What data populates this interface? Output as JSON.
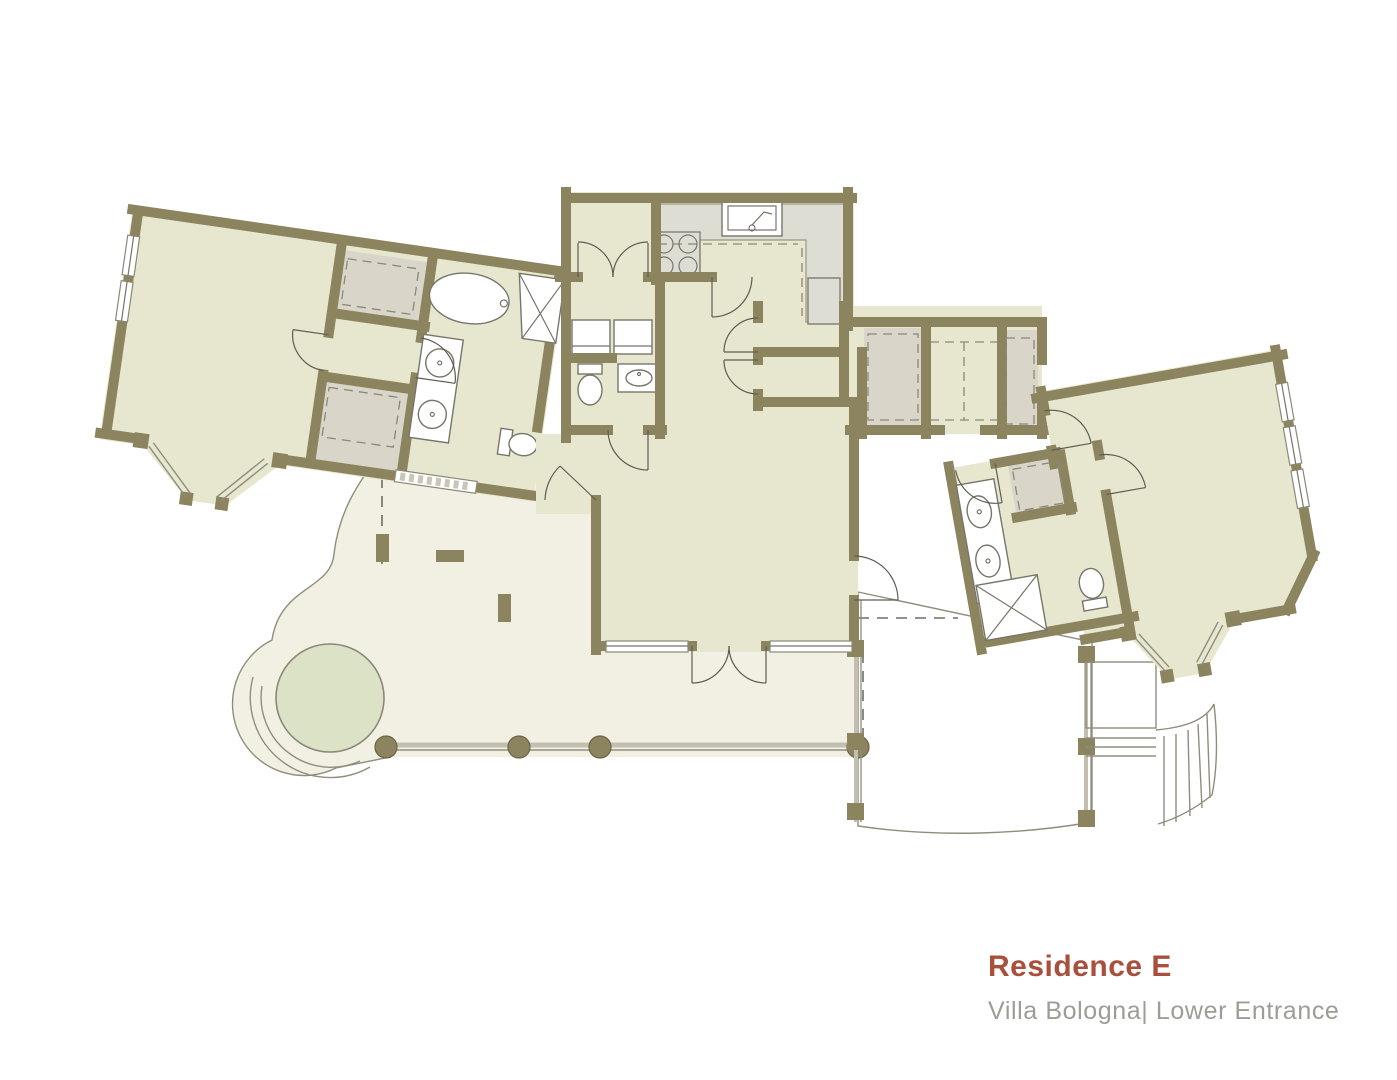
{
  "title": {
    "name": "Residence E",
    "subtitle": "Villa Bologna| Lower Entrance"
  },
  "palette": {
    "background": "#ffffff",
    "wall": "#8c845f",
    "room": "#e7e7cf",
    "closet": "#d9d6c9",
    "counter": "#deddd3",
    "deck": "#f2f0e3",
    "spa": "#dce2c6",
    "fixture": "#ffffff",
    "line": "#8f8d7c",
    "post": "#8c845f",
    "accent": "#a8503c",
    "subtitle": "#9d9d95"
  }
}
